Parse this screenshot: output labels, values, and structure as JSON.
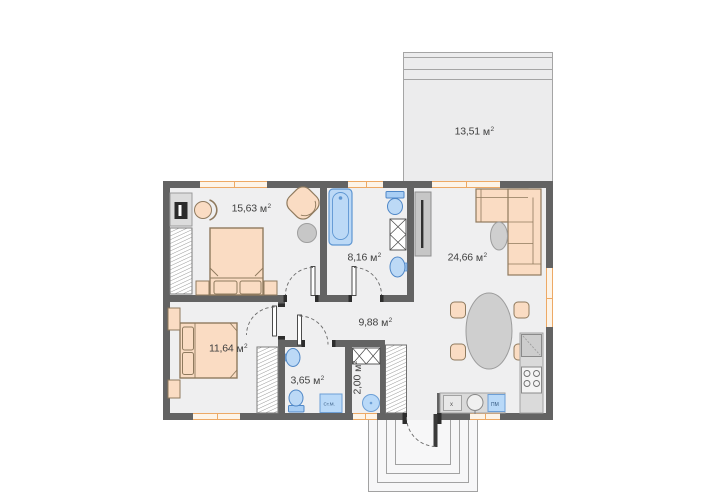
{
  "plan": {
    "unit": "м",
    "sup": "2",
    "rooms": {
      "terrace": {
        "area": "13,51"
      },
      "bedroom1": {
        "area": "15,63"
      },
      "bathroom": {
        "area": "8,16"
      },
      "living": {
        "area": "24,66"
      },
      "bedroom2": {
        "area": "11,64"
      },
      "hallway": {
        "area": "9,88"
      },
      "wc": {
        "area": "3,65"
      },
      "closet": {
        "area": "2,00"
      }
    },
    "appliances": {
      "washing_machine": "Ст.М.",
      "dishwasher": "ПМ",
      "hob": "x"
    },
    "colors": {
      "wall": "#636363",
      "floor": "#efeff0",
      "terrace_floor": "#ececed",
      "furniture_wood": "#fadcc3",
      "furniture_outline": "#8f7a5e",
      "plumbing_fill": "#b9d9f8",
      "plumbing_outline": "#4f87c7",
      "window_frame": "#eda965",
      "gray_fixture": "#cfcfcf",
      "label_text": "#3f3f3f"
    }
  }
}
